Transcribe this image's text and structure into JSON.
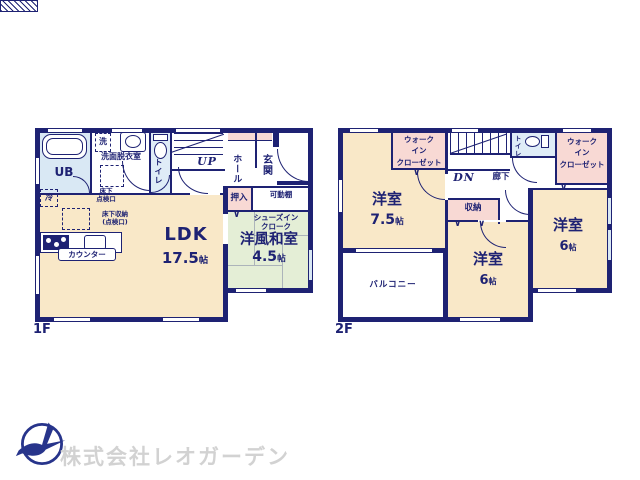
{
  "colors": {
    "wall": "#1e2273",
    "cream": "#f9e8c8",
    "pink": "#f8d9d4",
    "blue": "#d9e8f4",
    "green": "#e4eed6",
    "logo_blue": "#27348b",
    "company_gray": "#d2d2d2"
  },
  "floor1": {
    "label": "1F",
    "ub": "UB",
    "washer": "洗",
    "washroom": "洗面脱衣室",
    "toilet": "トイレ",
    "stairs": "UP",
    "hall": "ホール",
    "entrance": "玄関",
    "oshiire": "押入",
    "movable_shelf": "可動棚",
    "fridge": "冷",
    "underfloor_hatch_l1": "床下",
    "underfloor_hatch_l2": "点検口",
    "underfloor_storage_l1": "床下収納",
    "underfloor_storage_l2": "(点検口)",
    "counter": "カウンター",
    "shoes_cloak_l1": "シューズイン",
    "shoes_cloak_l2": "クローク",
    "washitsu_name": "洋風和室",
    "washitsu_size": "4.5",
    "washitsu_unit": "帖",
    "ldk_name": "LDK",
    "ldk_size": "17.5",
    "ldk_unit": "帖"
  },
  "floor2": {
    "label": "2F",
    "wic_left_l1": "ウォーク",
    "wic_left_l2": "イン",
    "wic_left_l3": "クローゼット",
    "wic_right_l1": "ウォーク",
    "wic_right_l2": "イン",
    "wic_right_l3": "クローゼット",
    "stairs": "DN",
    "corridor": "廊下",
    "toilet": "トイレ",
    "storage": "収納",
    "bedroom1_name": "洋室",
    "bedroom1_size": "7.5",
    "bedroom1_unit": "帖",
    "bedroom2_name": "洋室",
    "bedroom2_size": "6",
    "bedroom2_unit": "帖",
    "bedroom3_name": "洋室",
    "bedroom3_size": "6",
    "bedroom3_unit": "帖",
    "balcony": "バルコニー"
  },
  "footer": {
    "company": "株式会社レオガーデン"
  }
}
